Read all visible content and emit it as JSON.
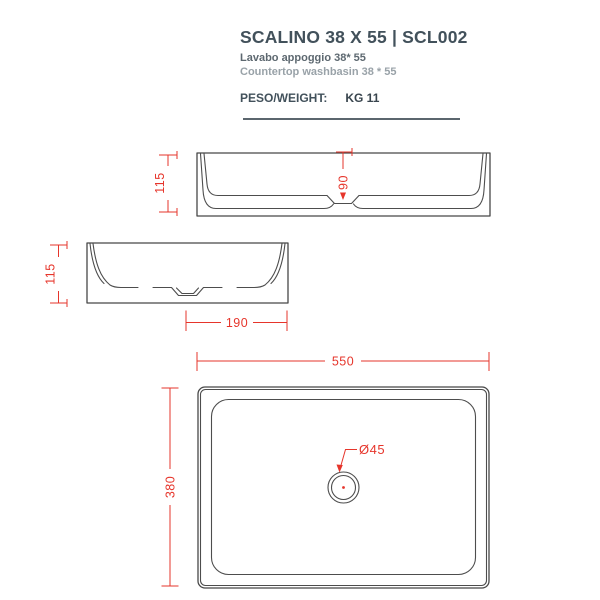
{
  "header": {
    "title": "SCALINO 38 X 55 | SCL002",
    "subtitle_it": "Lavabo appoggio 38* 55",
    "subtitle_en": "Countertop washbasin 38 * 55",
    "weight_label": "PESO/WEIGHT:",
    "weight_value": "KG 11"
  },
  "drawing": {
    "accent_color": "#e6352b",
    "line_color": "#4d4d4d",
    "views": {
      "side_long": "front elevation (long side)",
      "side_short": "side elevation (short side)",
      "top": "plan view"
    },
    "dimensions": {
      "side_long_height": "115",
      "basin_depth": "90",
      "side_short_height": "115",
      "drain_offset": "190",
      "top_width": "550",
      "top_depth": "380",
      "drain_diameter": "Ø45"
    }
  }
}
